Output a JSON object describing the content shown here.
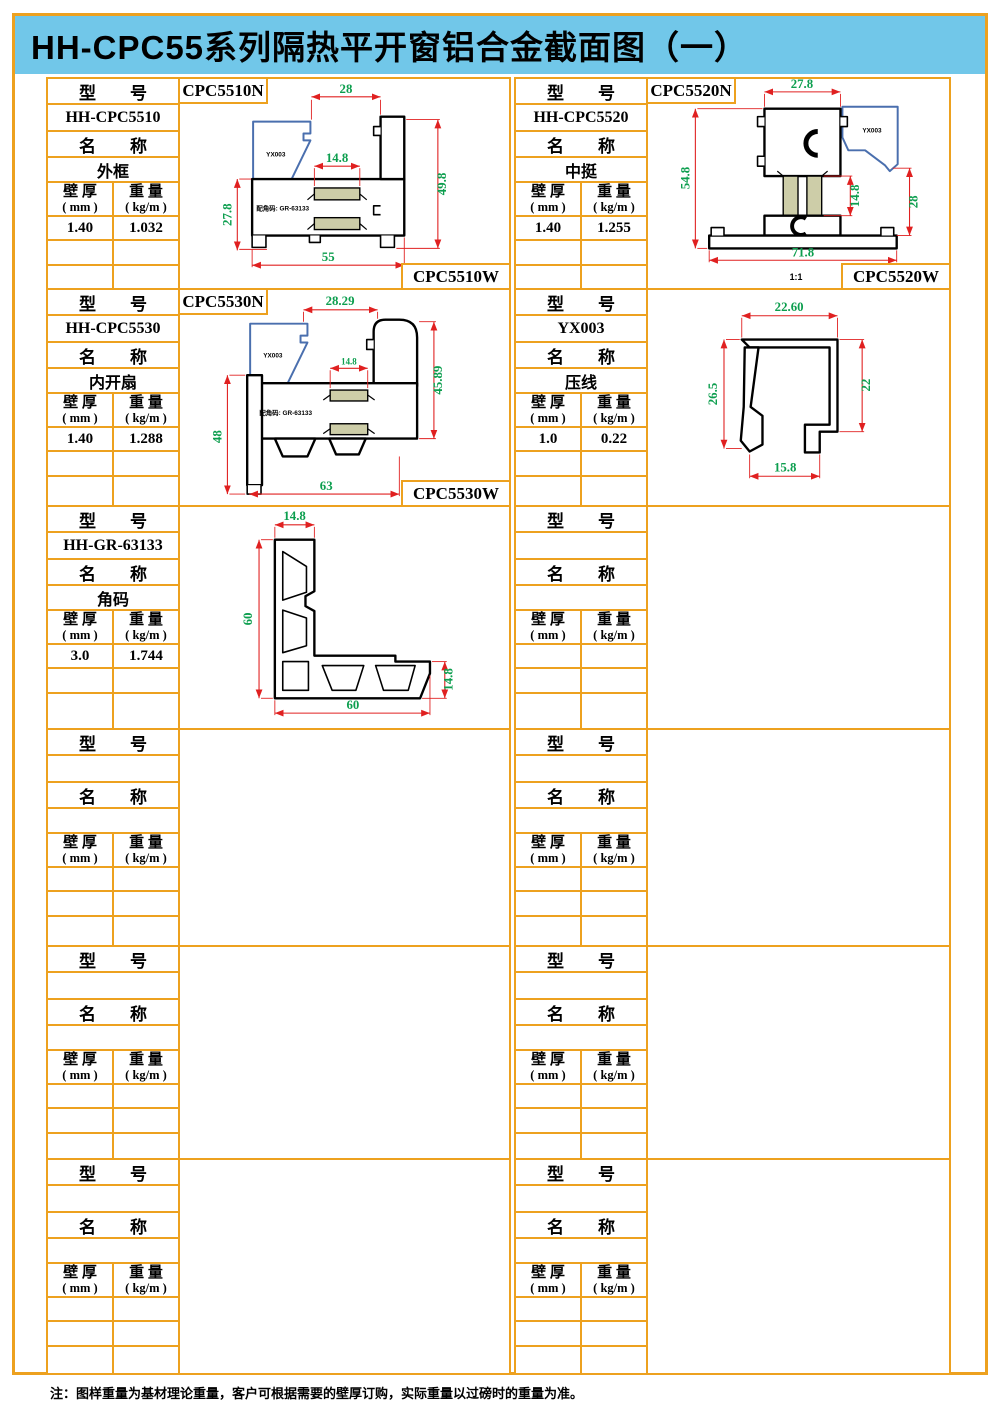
{
  "title": "HH-CPC55系列隔热平开窗铝合金截面图（一）",
  "note": "注：图样重量为基材理论重量，客户可根据需要的壁厚订购，实际重量以过磅时的重量为准。",
  "labels": {
    "model_header": "型　　号",
    "name_header": "名　　称",
    "thickness_header": "壁 厚",
    "thickness_unit": "( mm )",
    "weight_header": "重 量",
    "weight_unit": "( kg/m )"
  },
  "colors": {
    "border_orange": "#EDA11F",
    "title_blue": "#71C7E9",
    "dim_green": "#0C9E4E",
    "dim_red": "#E02020",
    "bead_blue": "#4A6FAE",
    "thermal_tan": "#CDCDA8"
  },
  "cells": [
    {
      "model": "HH-CPC5510",
      "name": "外框",
      "thickness": "1.40",
      "weight": "1.032",
      "label_n": "CPC5510N",
      "label_w": "CPC5510W",
      "dims": {
        "top": "28",
        "mid": "14.8",
        "left": "27.8",
        "right": "49.8",
        "bottom": "55"
      },
      "annotations": {
        "bead": "YX003",
        "corner": "配角码: GR-63133"
      }
    },
    {
      "model": "HH-CPC5520",
      "name": "中挺",
      "thickness": "1.40",
      "weight": "1.255",
      "label_n": "CPC5520N",
      "label_w": "CPC5520W",
      "dims": {
        "top": "27.8",
        "mid": "14.8",
        "left": "54.8",
        "right": "28",
        "bottom": "71.8"
      },
      "annotations": {
        "bead": "YX003",
        "scale": "1:1"
      }
    },
    {
      "model": "HH-CPC5530",
      "name": "内开扇",
      "thickness": "1.40",
      "weight": "1.288",
      "label_n": "CPC5530N",
      "label_w": "CPC5530W",
      "dims": {
        "top": "28.29",
        "mid": "14.8",
        "left": "48",
        "right": "45.89",
        "bottom": "63"
      },
      "annotations": {
        "bead": "YX003",
        "corner": "配角码: GR-63133"
      }
    },
    {
      "model": "YX003",
      "name": "压线",
      "thickness": "1.0",
      "weight": "0.22",
      "dims": {
        "top": "22.60",
        "left": "26.5",
        "right": "22",
        "bottom": "15.8"
      }
    },
    {
      "model": "HH-GR-63133",
      "name": "角码",
      "thickness": "3.0",
      "weight": "1.744",
      "dims": {
        "top": "14.8",
        "left": "60",
        "right": "14.8",
        "bottom": "60"
      }
    },
    {
      "model": "",
      "name": "",
      "thickness": "",
      "weight": ""
    },
    {
      "model": "",
      "name": "",
      "thickness": "",
      "weight": ""
    },
    {
      "model": "",
      "name": "",
      "thickness": "",
      "weight": ""
    },
    {
      "model": "",
      "name": "",
      "thickness": "",
      "weight": ""
    },
    {
      "model": "",
      "name": "",
      "thickness": "",
      "weight": ""
    },
    {
      "model": "",
      "name": "",
      "thickness": "",
      "weight": ""
    },
    {
      "model": "",
      "name": "",
      "thickness": "",
      "weight": ""
    }
  ]
}
